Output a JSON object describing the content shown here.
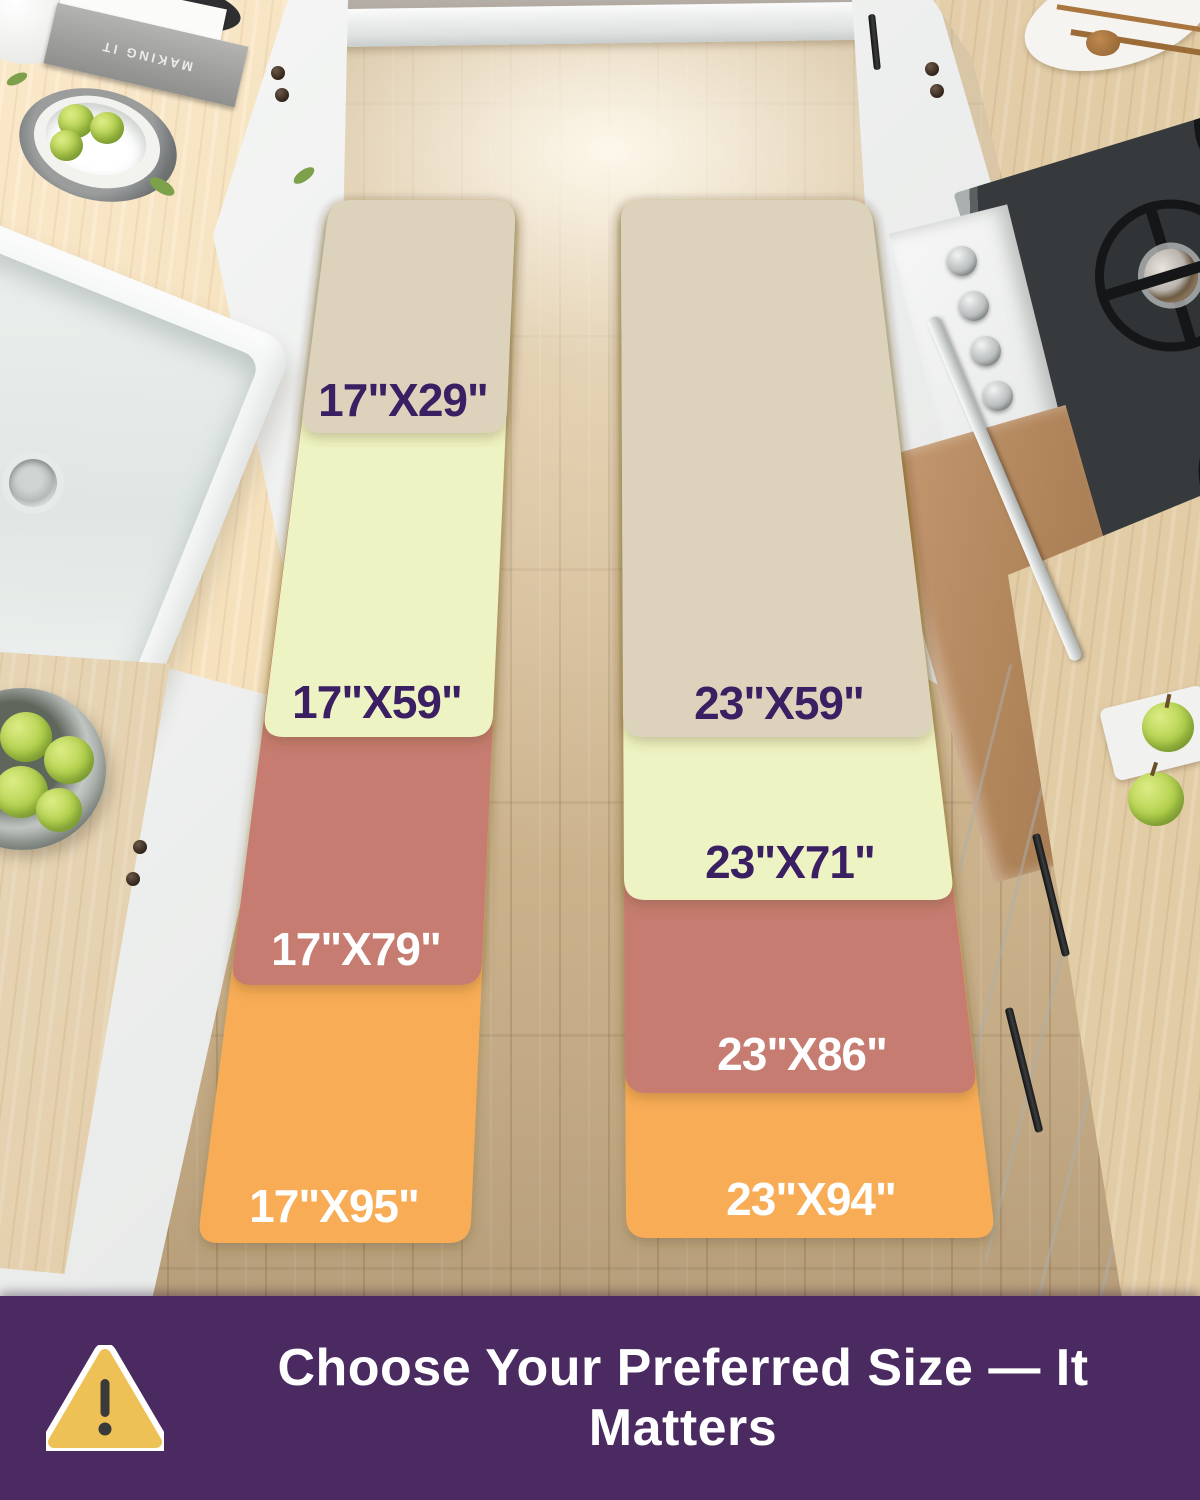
{
  "size_chart": {
    "runners": [
      {
        "id": "runner-17",
        "segments": [
          {
            "label": "17\"X29\"",
            "color": "#ddd3bc",
            "label_color": "#3a2062"
          },
          {
            "label": "17\"X59\"",
            "color": "#eef3c3",
            "label_color": "#3a2062"
          },
          {
            "label": "17\"X79\"",
            "color": "#c67c6f",
            "label_color": "#ffffff"
          },
          {
            "label": "17\"X95\"",
            "color": "#f8ac57",
            "label_color": "#ffffff"
          }
        ]
      },
      {
        "id": "runner-23",
        "segments": [
          {
            "label": "23\"X59\"",
            "color": "#ddd3bc",
            "label_color": "#3a2062"
          },
          {
            "label": "23\"X71\"",
            "color": "#eef3c3",
            "label_color": "#3a2062"
          },
          {
            "label": "23\"X86\"",
            "color": "#c67c6f",
            "label_color": "#ffffff"
          },
          {
            "label": "23\"X94\"",
            "color": "#f8ac57",
            "label_color": "#ffffff"
          }
        ]
      }
    ]
  },
  "banner": {
    "text": "Choose Your Preferred Size — It Matters",
    "background": "#4a2a60",
    "text_color": "#ffffff",
    "icon": "warning-triangle",
    "icon_fill": "#eec156",
    "icon_mark_color": "#3a3a3a"
  },
  "decor": {
    "book_spine": "MAKING IT"
  }
}
